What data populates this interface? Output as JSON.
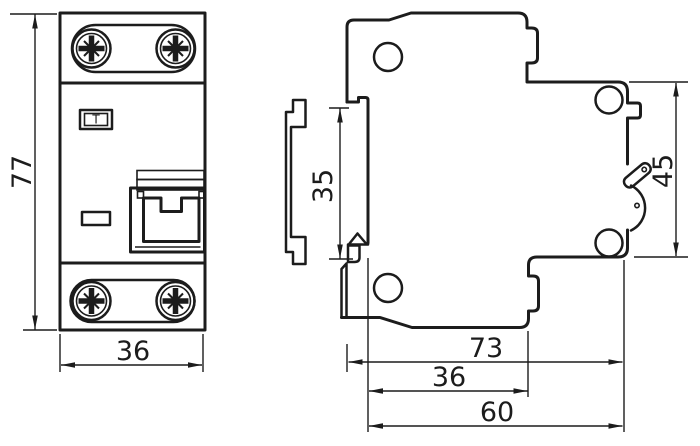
{
  "drawing": {
    "description": "Dimensional drawing of a DIN-rail modular circuit breaker (front and side views)",
    "colors": {
      "line": "#1c1c1c",
      "background": "#ffffff"
    },
    "front_view": {
      "test_button": "T",
      "height_mm": "77",
      "width_mm": "36"
    },
    "side_view": {
      "rail_height_mm": "35",
      "front_height_mm": "45",
      "depth_total_mm": "73",
      "depth_to_step_mm": "36",
      "depth_body_mm": "60"
    }
  }
}
